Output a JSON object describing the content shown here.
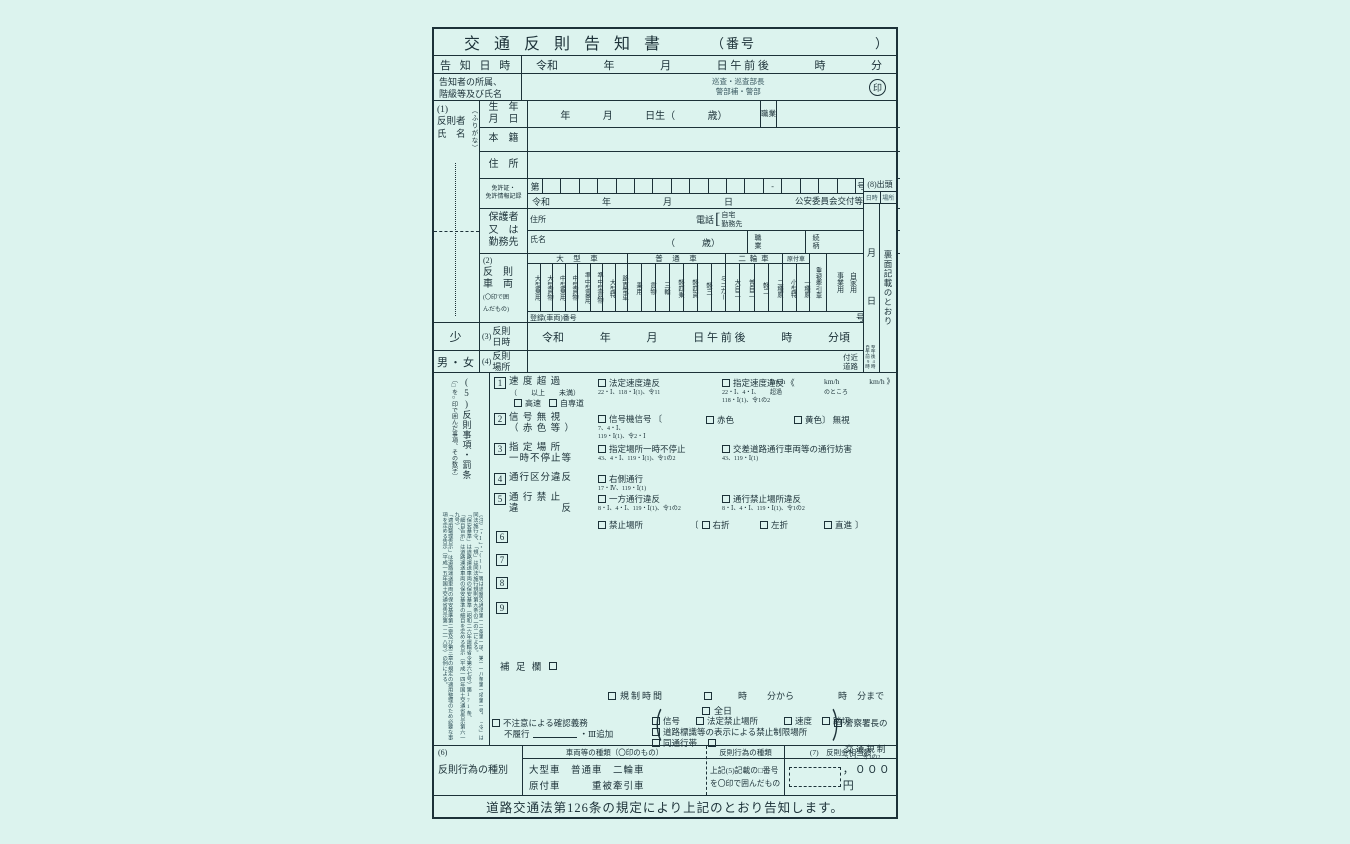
{
  "page": {
    "bg": "#dcf3ee",
    "ink": "#1c3138"
  },
  "title": {
    "text": "交 通 反 則 告 知 書",
    "number_open": "（番号",
    "number_close": "）"
  },
  "notice": {
    "label": "告 知 日 時",
    "t": [
      "令和",
      "年",
      "月",
      "日 午 前 後",
      "時",
      "分"
    ]
  },
  "notifier": {
    "label1": "告知者の所属、",
    "label2": "階級等及び氏名",
    "rank1": "巡査・巡査部長",
    "rank2": "警部補・警部",
    "seal": "印"
  },
  "offender": {
    "sec": "(1)",
    "l1": "反則者",
    "l2": "氏　名",
    "furigana": "（ふりがな）"
  },
  "birth": {
    "l1": "生　年",
    "l2": "月　日",
    "t": [
      "年",
      "月",
      "日生（",
      "歳）"
    ],
    "job": "職業"
  },
  "honseki": "本　籍",
  "jusho": "住　所",
  "license": {
    "l1": "免許証・",
    "l2": "免許情報記録",
    "first": "第",
    "dash": "-",
    "last": "号",
    "era": "令和",
    "y": "年",
    "m": "月",
    "d": "日",
    "issuer": "公安委員会交付等"
  },
  "guardian": {
    "l1": "保護者",
    "l2": "又　は",
    "l3": "勤務先",
    "addr": "住所",
    "tel": "電話",
    "bracket": "[",
    "tel1": "自宅",
    "tel2": "勤務先",
    "name": "氏名",
    "age": "（　　　歳）",
    "job": "職　業",
    "rel": "続　柄"
  },
  "appear": {
    "sec": "(8)出頭",
    "c1": "日時",
    "c2": "場所",
    "m": "月",
    "d": "日",
    "from": "自午前9時",
    "to": "至午後4時",
    "place": "裏面記載のとおり"
  },
  "veh": {
    "sec": "(2)",
    "l1": "反　則",
    "l2": "車　両",
    "note1": "(〇印で囲",
    "note2": "んだもの)",
    "g1": "大　型　車",
    "g1c": [
      "大型乗用",
      "大型貨物",
      "中型乗用",
      "中型貨物",
      "準中型乗用",
      "準中型貨物",
      "大型特",
      "路面電車"
    ],
    "g2": "普　通　車",
    "g2c": [
      "乗用",
      "貨物",
      "三輪",
      "軽四乗",
      "軽四貨",
      "軽三",
      "ミニカー"
    ],
    "g3": "二 輪 車",
    "g3c": [
      "大自二",
      "普自二",
      "軽二",
      "二種原"
    ],
    "g4": "原付車",
    "g4c": [
      "小型特",
      "一種原"
    ],
    "heavy": "重被牽引車",
    "biz": "事業用",
    "priv": "自家用",
    "reg": "登録(車両)番号",
    "reg_suffix": "号"
  },
  "vdt": {
    "minor": "少",
    "sec": "(3)",
    "l1": "反則",
    "l2": "日時",
    "t": [
      "令和",
      "年",
      "月",
      "日 午 前 後",
      "時",
      "分頃"
    ]
  },
  "vpl": {
    "sex": "男・女",
    "sec": "(4)",
    "l1": "反則",
    "l2": "場所",
    "near1": "付近",
    "near2": "道路"
  },
  "v5": {
    "head": "(5)反則事項・罰条",
    "note": "〔□を○印で囲んだ事項、その数字〕",
    "legal": [
      "（注）「・Ⅰ」・「(1)」等は道路交通法第一二条第一項、第一一八条第一項第一号、「令」は同法施行令、「規」は同法施行規則第九条の二の二による。",
      "「保安基準」は道路運送車両の保安基準（昭和二六年運輸省令第六七号）第171条、",
      "「細目告示」は道路運送車両の保安基準の細目を定める告示（平成一四年国土交通省告示第六一九号）、",
      "「適用整理告示」は道路運送車両の保安基準第二章及び第三章の規定の適用整理のため必要な事項を定める告示（平成一五年国土交通省告示第一二一八号）の例による。"
    ],
    "i1": {
      "no": "1",
      "l": "速 度 超 過",
      "sub": "（　　以上　　未満）",
      "e1": "高速",
      "e2": "自専道",
      "o1": "法定速度違反",
      "r1": "22・Ⅰ、118・Ⅰ(1)、令11",
      "o2": "指定速度違反 《",
      "r2a": "22・Ⅰ、4・Ⅰ、",
      "r2b": "118・Ⅰ(1)、令1の2",
      "s1": "km/h",
      "s1b": "超過",
      "s2": "km/h",
      "s2b": "のところ",
      "s3": "km/h 》"
    },
    "i2": {
      "no": "2",
      "l": "信 号 無 視",
      "l2": "（ 赤 色 等 ）",
      "o1": "信号機信号 〔",
      "r1a": "7、4・Ⅰ、",
      "r1b": "119・Ⅰ(1)、令2・Ⅰ",
      "c1": "赤色",
      "c2": "黄色〕 無視"
    },
    "i3": {
      "no": "3",
      "l": "指 定 場 所",
      "l2": "一時不停止等",
      "o1": "指定場所一時不停止",
      "r1": "43、4・Ⅰ、119・Ⅰ(1)、令1の2",
      "o2": "交差道路通行車両等の通行妨害",
      "r2": "43、119・Ⅰ(1)"
    },
    "i4": {
      "no": "4",
      "l": "通行区分違反",
      "o1": "右側通行",
      "r1": "17・Ⅳ、119・Ⅰ(1)"
    },
    "i5": {
      "no": "5",
      "l": "通 行 禁 止",
      "l2": "違　　　　反",
      "o1": "一方通行違反",
      "r1": "8・Ⅰ、4・Ⅰ、119・Ⅰ(1)、令1の2",
      "o2": "通行禁止場所違反",
      "r2": "8・Ⅰ、4・Ⅰ、119・Ⅰ(1)、令1の2",
      "o3": "禁止場所",
      "b1": "〔",
      "c1": "右折",
      "c2": "左折",
      "c3": "直進",
      "b2": "〕"
    },
    "i6": "6",
    "i7": "7",
    "i8": "8",
    "i9": "9",
    "supp": "補 足 欄",
    "reg": {
      "l": "規制時間",
      "t1": "時",
      "t2": "分から",
      "t3": "時",
      "t4": "分まで",
      "all": "全日"
    },
    "bot": {
      "c1": "不注意による確認義務",
      "c2": "不履行",
      "c3": "・Ⅲ追加",
      "g1": "信号",
      "g2": "法定禁止場所",
      "g3": "速度",
      "g4": "踏切",
      "g5": "道路標識等の表示による禁止制限場所",
      "g6": "同通行帯",
      "p1": "警察署長の",
      "p2": "交 通 規 制",
      "pr": "5・Ⅰ、令3の2"
    }
  },
  "cat": {
    "sec": "(6)",
    "l": "反則行為の種別",
    "vh": "車両等の種類（〇印のもの）",
    "v1": "大型車　普通車　二輪車",
    "v2": "原付車　　　重被牽引車",
    "ah": "反則行為の種類",
    "a1": "上記(5)記載の□番号",
    "a2": "を〇印で囲んだもの",
    "mh": "(7)　反則金相当額",
    "amt": "，０００円"
  },
  "footer": "道路交通法第126条の規定により上記のとおり告知します。"
}
